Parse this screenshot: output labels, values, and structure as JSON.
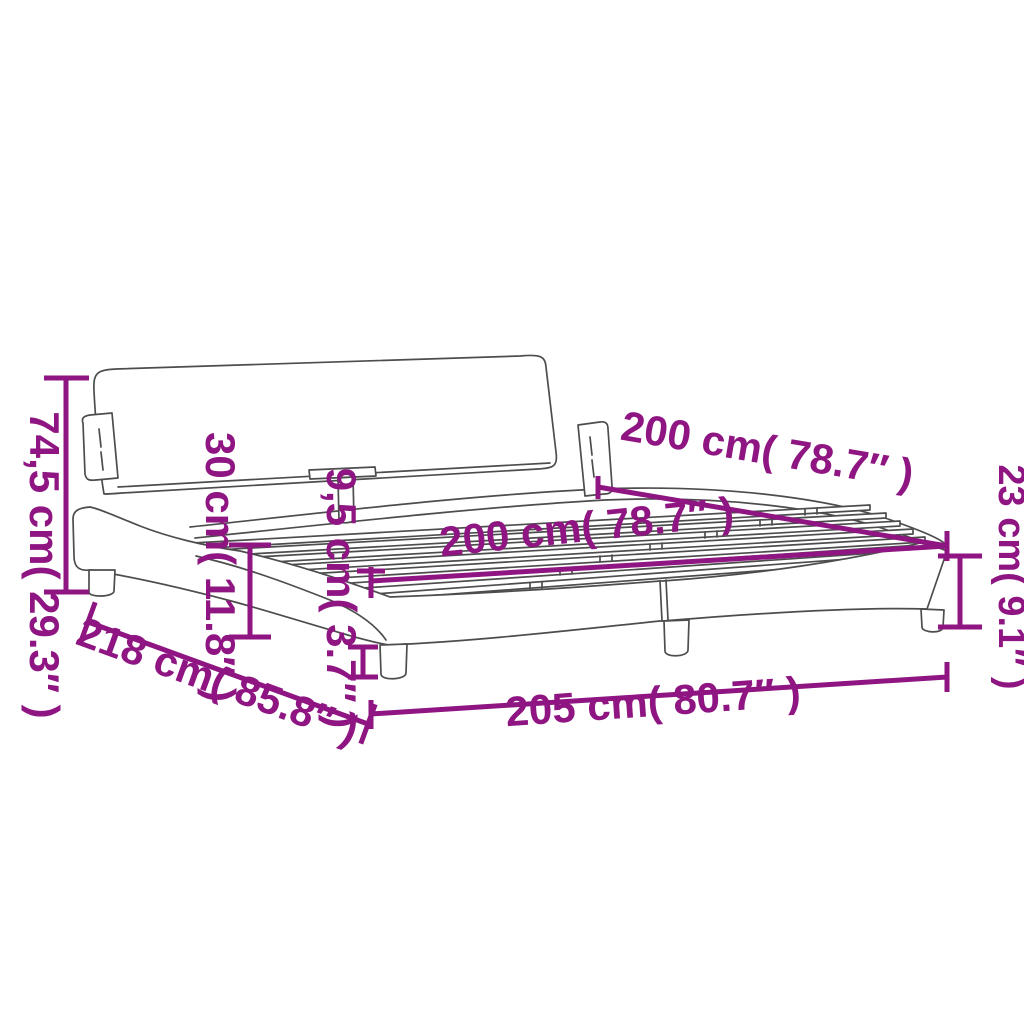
{
  "diagram": {
    "type": "product-dimension-diagram",
    "subject": "upholstered bed frame with curved side rails, headboard and slatted base",
    "background_color": "#ffffff",
    "accent_color": "#8e1582",
    "artwork_line_color": "#4d4d4d",
    "labels": {
      "total_height": "74,5 cm( 29.3″ )",
      "headboard_height": "30 cm( 11.8″ )",
      "rail_top_height": "9,5 cm( 3.7″ )",
      "length_top": "200 cm( 78.7″ )",
      "width_inner": "200 cm( 78.7″ )",
      "frame_height": "23 cm( 9.1″ )",
      "total_length_diagonal": "218 cm( 85.8″ )",
      "base_length": "205 cm( 80.7″ )"
    }
  }
}
